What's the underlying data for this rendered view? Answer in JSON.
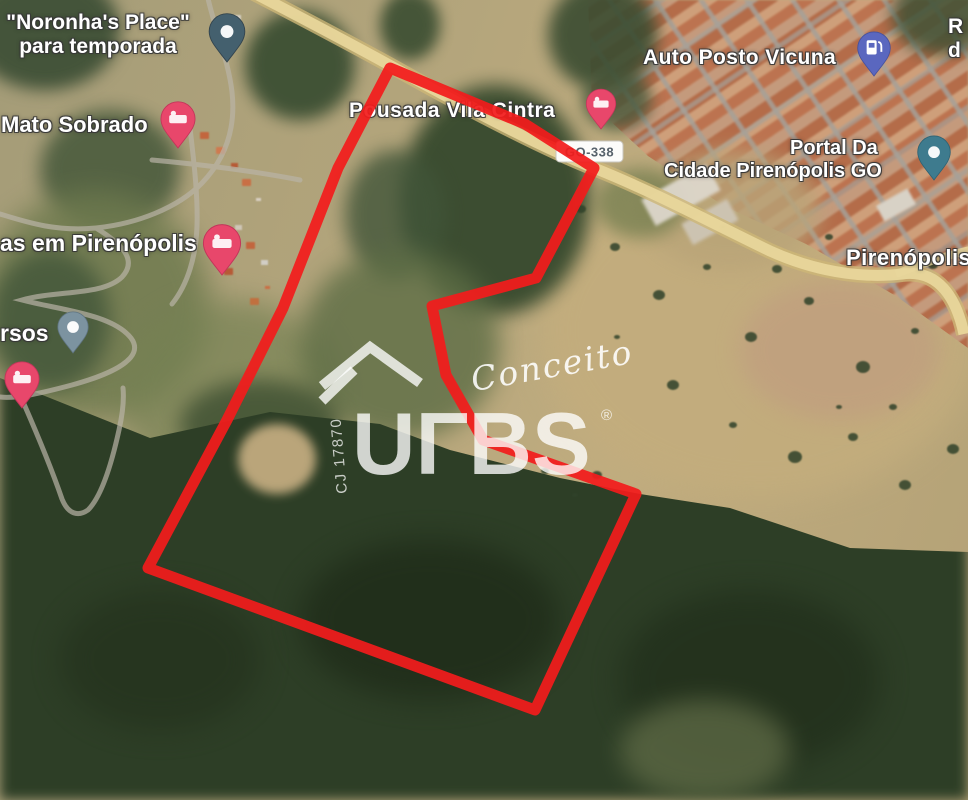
{
  "map": {
    "labels": {
      "noronha_line1": "\"Noronha's Place\"",
      "noronha_line2": "para temporada",
      "mato_sobrado": "Mato Sobrado",
      "pousada": "Pousada Vila Cintra",
      "auto_posto": "Auto Posto Vicuna",
      "portal_line1": "Portal Da",
      "portal_line2": "Cidade Pirenópolis GO",
      "casas_clipped": "as em Pirenópolis",
      "rsos_clipped": "rsos",
      "town": "Pirenópolis",
      "partial_right_line1": "R",
      "partial_right_line2": "d"
    },
    "road_shield": "GO-338",
    "colors": {
      "parcel_red": "#f21c1c",
      "road_core": "#e8d69b",
      "road_casing": "#cdb777",
      "pin_pink": "#e8476b",
      "pin_slate": "#44606e",
      "pin_teal": "#3e7b8e",
      "pin_light_slate": "#7c93a0",
      "pin_gas_blue": "#5a67bf"
    },
    "geometry": {
      "parcel_outline_points": "390,68 525,124 594,168 536,278 432,306 446,375 483,440 636,494 535,710 148,568 227,420 283,308 338,168",
      "go338_path": "M 252,-8 C 300,17 352,44 402,72 C 452,100 540,147 594,168 C 652,191 712,223 770,251 C 812,270 858,279 902,274 C 938,269 956,297 964,334",
      "go338_branch_path": "M 896,274 C 922,264 944,256 970,250",
      "rural_roads_path": "M 207,-6 C 214,28 228,58 232,92 C 236,128 226,158 202,183 C 178,208 136,224 96,228 C 56,232 26,222 0,214 M 96,228 C 122,244 138,260 122,277 C 102,296 58,290 22,300 C 60,310 112,314 131,338 C 146,358 112,374 72,385 C 42,393 16,399 0,397 M 24,404 C 38,436 52,470 62,499 C 68,514 78,517 88,510 C 102,496 112,462 119,430 C 123,412 124,398 123,388 M 190,128 C 194,162 198,196 197,226 C 196,256 188,284 172,304 M 152,160 C 196,164 248,170 300,180"
    }
  },
  "watermark": {
    "script_text": "Conceito",
    "brand_text": "UΓBS",
    "registered_mark": "®",
    "code": "CJ 17870"
  }
}
